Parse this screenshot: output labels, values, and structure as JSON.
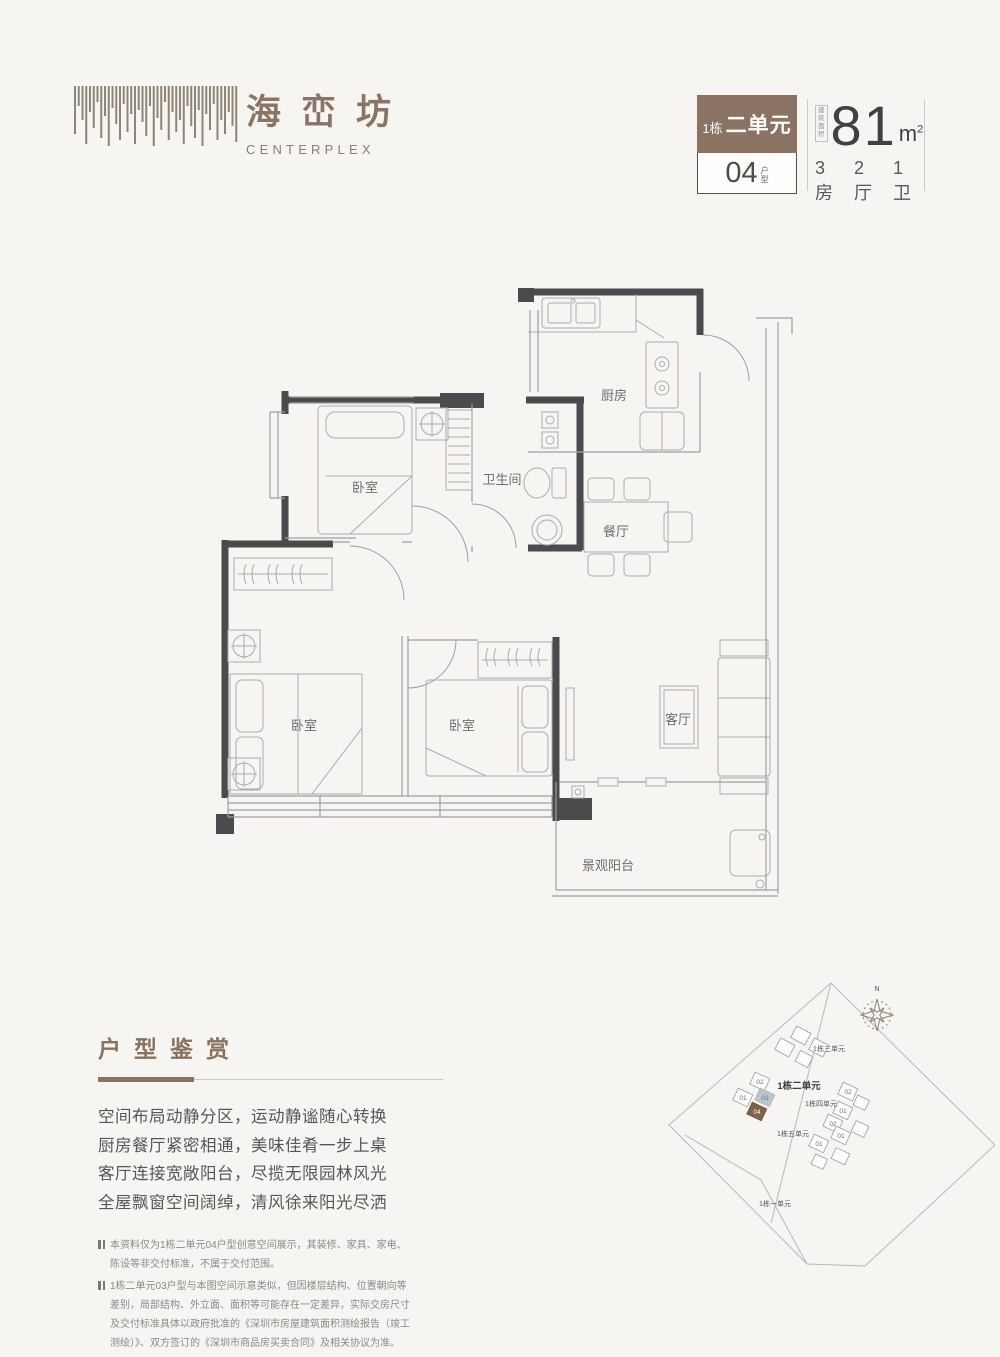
{
  "logo": {
    "chars": [
      "海",
      "峦",
      "坊"
    ],
    "en": "CENTERPLEX"
  },
  "badge": {
    "block_no": "1栋",
    "unit": "二单元",
    "type_no": "04",
    "type_suffix": [
      "户",
      "型"
    ]
  },
  "area": {
    "prefix": [
      "建筑",
      "面积"
    ],
    "value": "81",
    "unit_base": "m",
    "unit_sup": "2",
    "rooms": "3房",
    "halls": "2厅",
    "baths": "1卫"
  },
  "plan": {
    "rooms": [
      {
        "label": "厨房"
      },
      {
        "label": "卫生间"
      },
      {
        "label": "餐厅"
      },
      {
        "label": "卧室"
      },
      {
        "label": "卧室"
      },
      {
        "label": "卧室"
      },
      {
        "label": "客厅"
      },
      {
        "label": "景观阳台"
      }
    ]
  },
  "showcase": {
    "title": "户型鉴赏",
    "lines": [
      "空间布局动静分区，运动静谧随心转换",
      "厨房餐厅紧密相通，美味佳肴一步上桌",
      "客厅连接宽敞阳台，尽揽无限园林风光",
      "全屋飘窗空间阔绰，清风徐来阳光尽洒"
    ]
  },
  "notes": [
    "本资料仅为1栋二单元04户型创意空间展示，其装修、家具、家电、陈设等非交付标准，不属于交付范围。",
    "1栋二单元03户型与本图空间示意类似，但因楼层结构、位置朝向等差别，局部结构、外立面、面积等可能存在一定差异，实际交房尺寸及交付标准具体以政府批准的《深圳市房屋建筑面积测绘报告（竣工测绘）》、双方签订的《深圳市商品房买卖合同》及相关协议为准。"
  ],
  "siteplan": {
    "north": "N",
    "buildings": [
      "1栋三单元",
      "1栋二单元",
      "1栋四单元",
      "1栋五单元",
      "1栋一单元"
    ],
    "units": [
      "02",
      "01",
      "03",
      "04",
      "02",
      "01",
      "02",
      "01",
      "01"
    ]
  },
  "colors": {
    "accent": "#8a7260",
    "badge_brown": "#8a7363",
    "wall": "#4a4b4d",
    "unit04_highlight": "#7e6347",
    "unit03_highlight": "#b9c6d0"
  }
}
